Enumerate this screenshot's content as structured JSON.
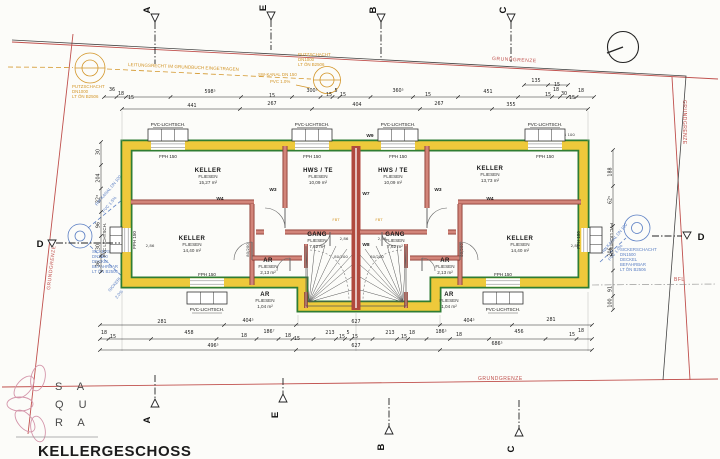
{
  "title": "KELLERGESCHOSS",
  "logo": {
    "rows": [
      "S A",
      "Q U",
      "R A"
    ]
  },
  "boundary": {
    "grundgrenze": "GRUNDGRENZE",
    "bfl": "BFL"
  },
  "markers": {
    "a": "A",
    "b": "B",
    "c": "C",
    "d": "D",
    "e": "E"
  },
  "utilities": {
    "putzschacht": [
      "PUTZSCHACHT",
      "DN1000",
      "LT ÖN B2506"
    ],
    "leitungsrecht": "LEITUNGSRECHT IM GRUNDBUCH EINGETRAGEN",
    "sw_kanal": "SW-KANAL DN 150",
    "sw_kanal_grade": "PVC 1.0%",
    "sickerschacht_left": [
      "SICKERSCH.",
      "DN2000",
      "DECKEL",
      "BEFAHRBAR",
      "LT ÖN B2506"
    ],
    "sickerschacht_right": [
      "SICKERSCHACHT",
      "DN1500",
      "DECKEL",
      "BEFAHRBAR",
      "LT ÖN B2506"
    ],
    "rw_kanal_left": [
      "RW-KANAL DN 100",
      "PVC 1.5%"
    ],
    "rw_kanal_right": [
      "RW-KANAL DN 100",
      "PVC 1.0%"
    ],
    "sickerl": [
      "SICKERL. DN 100",
      "2.0%"
    ],
    "rwr": "RWR 100"
  },
  "windows": {
    "shaft": "PVC-LICHTSCH.",
    "shaft_side": "PVC LICHTSCH.",
    "fph": "FPH 150"
  },
  "walls": {
    "w3": "W3",
    "w4": "W4",
    "w7": "W7",
    "w8": "W8",
    "w9": "W9"
  },
  "annotations": {
    "height": "2,86",
    "door": "80/200",
    "fbt": "FBT"
  },
  "rooms": [
    {
      "name": "KELLER",
      "finish": "FLIESEN",
      "area": "15,27 m²"
    },
    {
      "name": "HWS / TE",
      "finish": "FLIESEN",
      "area": "10,09 m²"
    },
    {
      "name": "KELLER",
      "finish": "FLIESEN",
      "area": "13,73 m²"
    },
    {
      "name": "HWS / TE",
      "finish": "FLIESEN",
      "area": "10,09 m²"
    },
    {
      "name": "KELLER",
      "finish": "FLIESEN",
      "area": "14,40 m²"
    },
    {
      "name": "KELLER",
      "finish": "FLIESEN",
      "area": "14,40 m²"
    },
    {
      "name": "GANG",
      "finish": "FLIESEN",
      "area": "7,62 m²"
    },
    {
      "name": "GANG",
      "finish": "FLIESEN",
      "area": "7,62 m²"
    },
    {
      "name": "AR",
      "finish": "FLIESEN",
      "area": "2,13 m²"
    },
    {
      "name": "AR",
      "finish": "FLIESEN",
      "area": "2,13 m²"
    },
    {
      "name": "AR",
      "finish": "FLIESEN",
      "area": "1,04 m²"
    },
    {
      "name": "AR",
      "finish": "FLIESEN",
      "area": "1,04 m²"
    }
  ],
  "dims": {
    "top_row1": [
      "36",
      "18",
      "15",
      "598⁵",
      "15",
      "300⁵",
      "15",
      "5",
      "15",
      "360⁵",
      "15",
      "451",
      "15",
      "18",
      "30",
      "15",
      "18"
    ],
    "top_mini": [
      "135",
      "15"
    ],
    "top_row2": [
      "441",
      "267",
      "404",
      "267",
      "355"
    ],
    "bottom_row1": [
      "281",
      "404⁵",
      "627",
      "404⁵",
      "281"
    ],
    "bottom_row2": [
      "18",
      "15",
      "458",
      "18",
      "186⁷",
      "18",
      "15",
      "213",
      "15",
      "5",
      "15",
      "213",
      "15",
      "18",
      "186⁵",
      "18",
      "456",
      "15",
      "18"
    ],
    "bottom_row3": [
      "496⁵",
      "627",
      "686⁵"
    ],
    "left_col": [
      "30",
      "204",
      "22³",
      "96",
      "30",
      "36"
    ],
    "right_col": [
      "188",
      "62⁵",
      "206",
      "91",
      "100"
    ]
  },
  "colors": {
    "wall_insulation": "#eec93b",
    "wall_outline": "#2f7d33",
    "wall_masonry": "#b0493e",
    "boundary": "#c0504d",
    "utility_orange": "#d3962a",
    "utility_blue": "#5b7fc4"
  }
}
